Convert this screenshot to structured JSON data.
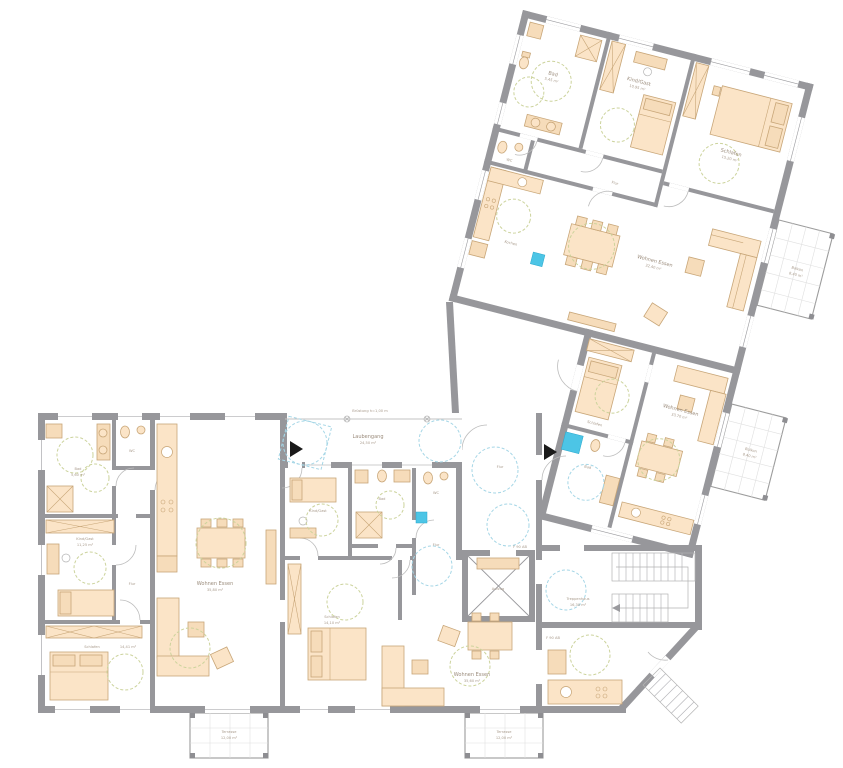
{
  "drawing": {
    "kind": "architectural floor plan, multi family house, ground floor",
    "language": "de"
  },
  "colors": {
    "wall_gray": "#97979b",
    "furniture_fill": "#fbe4c7",
    "furniture_stroke": "#c8a678",
    "tile_blue": "#4cc5e6",
    "clearance_circle_cyan": "#a5d6e6",
    "clearance_circle_khaki": "#ccd39c",
    "label_text": "#9b8c7c",
    "background": "#ffffff"
  },
  "rooms": {
    "bad_a": {
      "name": "Bad",
      "area": "5,60 m²"
    },
    "wc_a": {
      "name": "WC"
    },
    "kind_a": {
      "name": "Kind/Gast",
      "area": "11,25 m²"
    },
    "flur_a": {
      "name": "Flur"
    },
    "schlafen_a": {
      "name": "Schlafen",
      "area": "14,41 m²"
    },
    "wohnen_b": {
      "name": "Wohnen Essen",
      "area": "35,80 m²"
    },
    "laubengang": {
      "name": "Laubengang",
      "area": "24,50 m²"
    },
    "kind_c": {
      "name": "Kind/Gast",
      "area": "11,10 m²"
    },
    "bad_c": {
      "name": "Bad",
      "area": "5,35 m²"
    },
    "wc_c": {
      "name": "WC"
    },
    "flur_c": {
      "name": "Flur"
    },
    "schlafen_c": {
      "name": "Schlafen",
      "area": "14,10 m²"
    },
    "wohnen_c": {
      "name": "Wohnen Essen",
      "area": "35,60 m²"
    },
    "terrasse_1": {
      "name": "Terrasse",
      "area": "12,00 m²"
    },
    "terrasse_2": {
      "name": "Terrasse",
      "area": "12,00 m²"
    },
    "flur_core": {
      "name": "Flur"
    },
    "aufzug": {
      "name": "Aufzug"
    },
    "treppenhaus": {
      "name": "Treppenhaus",
      "area": "16,30 m²"
    },
    "bad_d": {
      "name": "Bad",
      "area": "5,45 m²"
    },
    "wc_d": {
      "name": "WC"
    },
    "kind_d": {
      "name": "Kind/Gast",
      "area": "10,95 m²"
    },
    "schlafen_d": {
      "name": "Schlafen",
      "area": "15,20 m²"
    },
    "flur_d": {
      "name": "Flur"
    },
    "kochen_d": {
      "name": "Kochen"
    },
    "wohnen_d": {
      "name": "Wohnen Essen",
      "area": "32,40 m²"
    },
    "balkon_1": {
      "name": "Balkon",
      "area": "8,40 m²"
    },
    "schlafen_e": {
      "name": "Schlafen",
      "area": "13,90 m²"
    },
    "bad_e": {
      "name": "Bad",
      "area": "5,10 m²"
    },
    "wohnen_e": {
      "name": "Wohnen Essen",
      "area": "33,70 m²"
    },
    "balkon_2": {
      "name": "Balkon",
      "area": "8,40 m²"
    }
  },
  "annotations": {
    "fire_rating_1": "F 90 AB",
    "fire_rating_2": "F 90 AB",
    "walkway_note": "Brüstung h=1,00 m"
  }
}
